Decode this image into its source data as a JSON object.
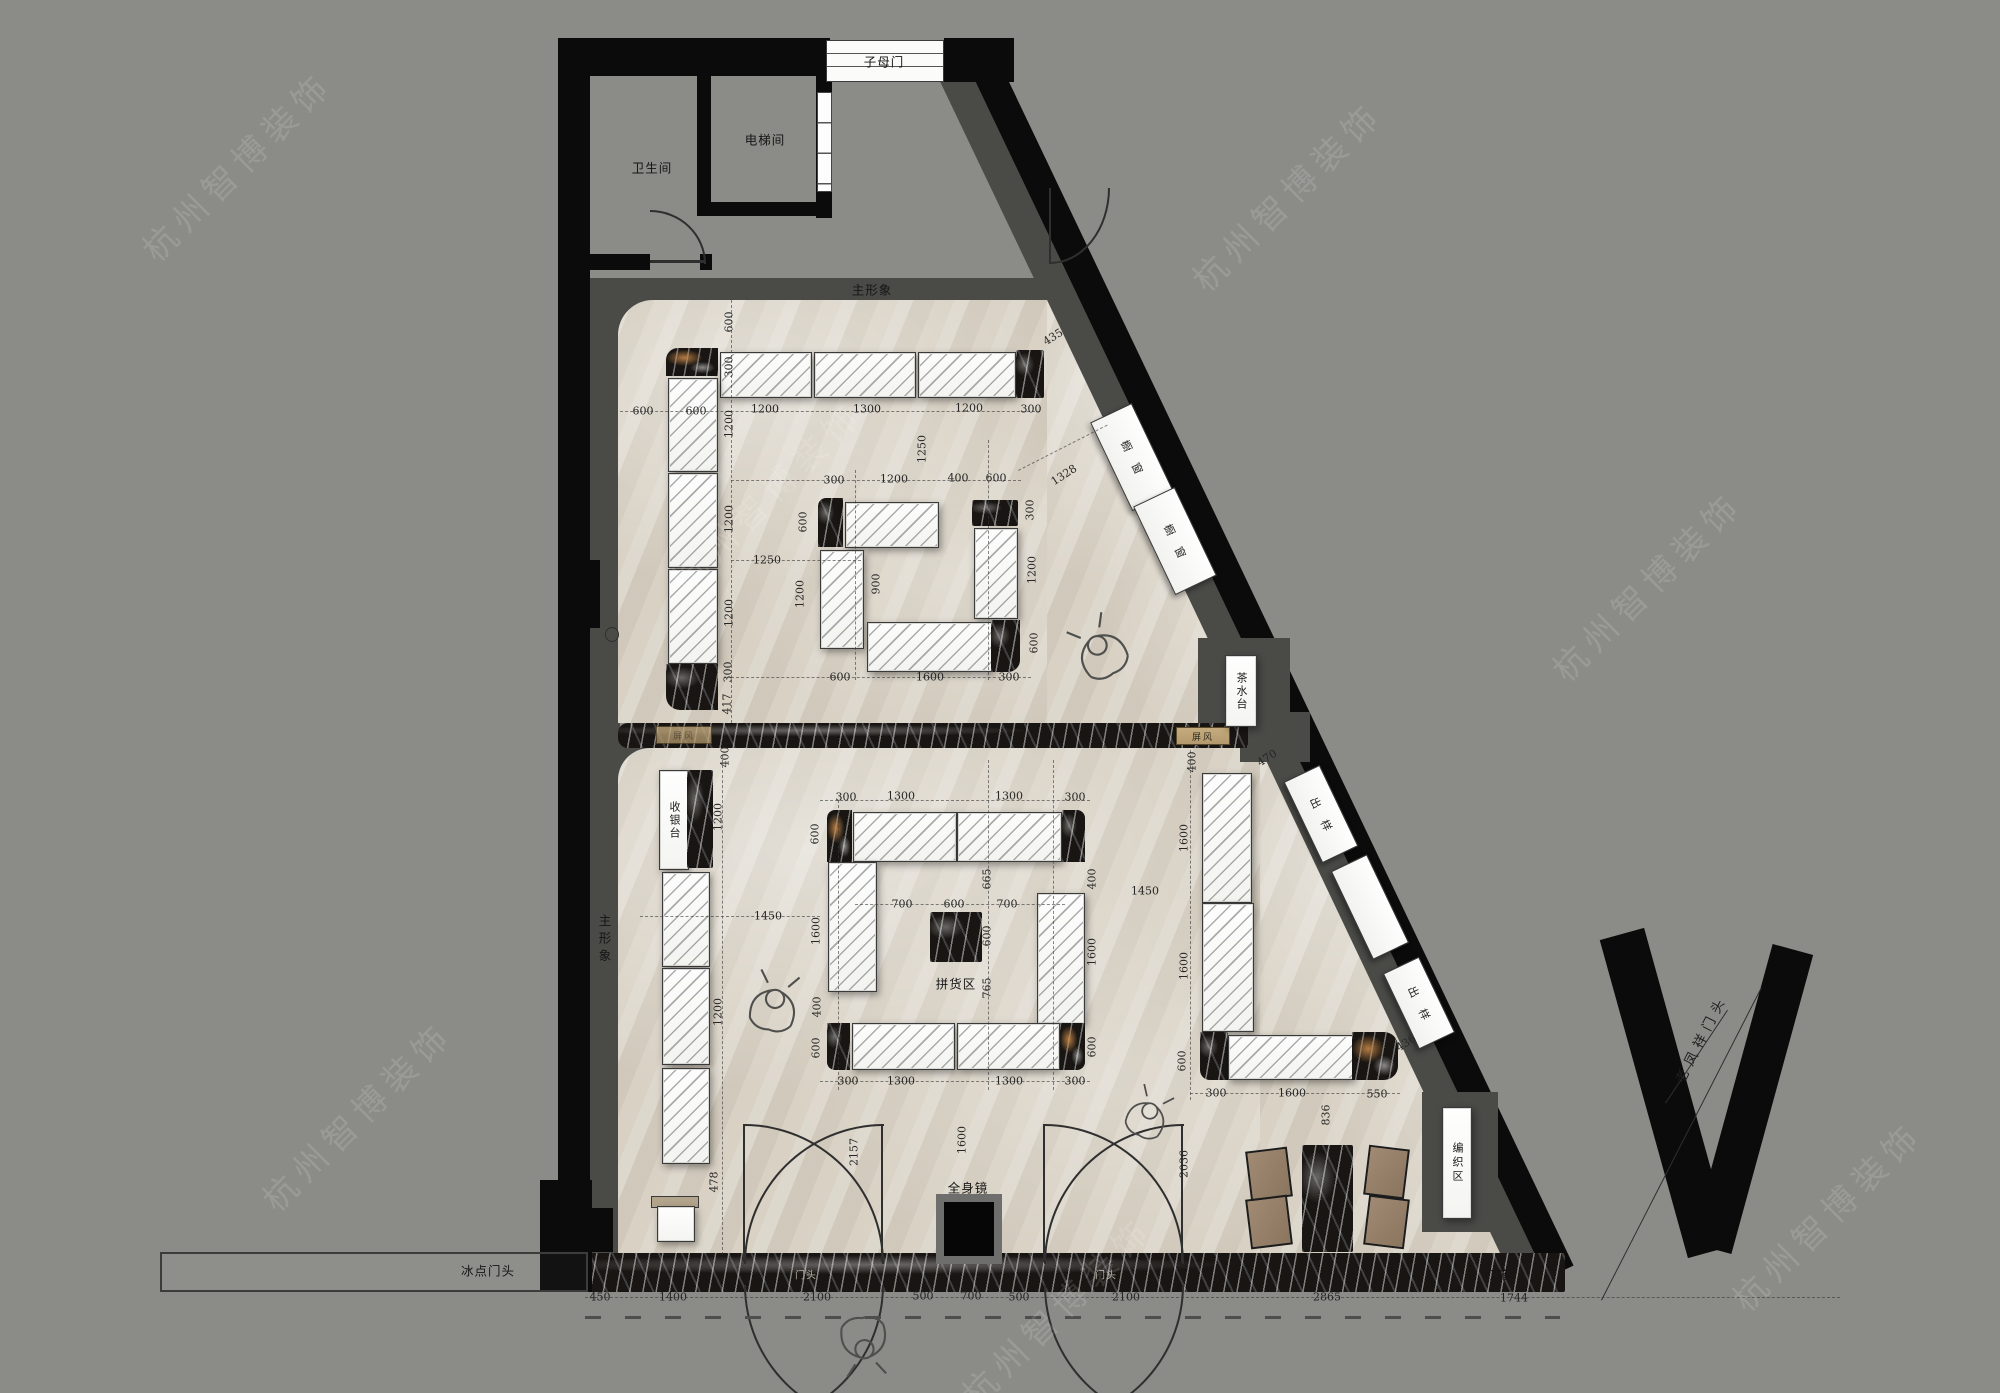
{
  "title": "老凤祥珠宝店 平面布置图",
  "watermark": "杭州智博装饰",
  "colors": {
    "bg": "#8b8c88",
    "wall": "#0b0b0b",
    "band": "#4a4a47",
    "floor": "#d7d0c3",
    "marble": "#181512",
    "tan": "#b49a6e",
    "chair": "#97816b",
    "wood": "#b3a48c"
  },
  "fixtures": {
    "cashier": "收银台",
    "tea": "茶水台",
    "weave": "编织区",
    "window": "橱窗",
    "sample": "出样",
    "screen": "屏风"
  },
  "annotations": {
    "labels": [
      {
        "t": "子母门",
        "x": 884,
        "y": 61,
        "r": 0,
        "c": "lbl"
      },
      {
        "t": "电梯间",
        "x": 765,
        "y": 139,
        "r": 0,
        "c": "lbl"
      },
      {
        "t": "卫生间",
        "x": 652,
        "y": 167,
        "r": 0,
        "c": "lbl"
      },
      {
        "t": "主形象",
        "x": 872,
        "y": 289,
        "r": 0,
        "c": "lbl"
      },
      {
        "t": "主形象",
        "x": 604,
        "y": 940,
        "r": 0,
        "c": "lbl v"
      },
      {
        "t": "拼货区",
        "x": 956,
        "y": 983,
        "r": 0,
        "c": "lbl"
      },
      {
        "t": "全身镜",
        "x": 968,
        "y": 1187,
        "r": 0,
        "c": "lbl"
      },
      {
        "t": "冰点门头",
        "x": 488,
        "y": 1270,
        "r": 0,
        "c": "lbl"
      },
      {
        "t": "灯箱",
        "x": 1497,
        "y": 1274,
        "r": 0,
        "c": "lbl"
      },
      {
        "t": "门头",
        "x": 806,
        "y": 1274,
        "r": 0,
        "c": "lbl light"
      },
      {
        "t": "门头",
        "x": 1106,
        "y": 1274,
        "r": 0,
        "c": "lbl light"
      },
      {
        "t": "老凤祥门头",
        "x": 1700,
        "y": 1038,
        "r": -63,
        "c": "lbl spaced"
      }
    ],
    "dims": [
      {
        "t": "600",
        "x": 729,
        "y": 322,
        "r": -90
      },
      {
        "t": "300",
        "x": 729,
        "y": 367,
        "r": -90
      },
      {
        "t": "600",
        "x": 643,
        "y": 411,
        "r": 0
      },
      {
        "t": "600",
        "x": 696,
        "y": 411,
        "r": 0
      },
      {
        "t": "1200",
        "x": 765,
        "y": 409,
        "r": 0
      },
      {
        "t": "1300",
        "x": 867,
        "y": 409,
        "r": 0
      },
      {
        "t": "1200",
        "x": 969,
        "y": 408,
        "r": 0
      },
      {
        "t": "300",
        "x": 1031,
        "y": 409,
        "r": 0
      },
      {
        "t": "435",
        "x": 1053,
        "y": 337,
        "r": -32
      },
      {
        "t": "1200",
        "x": 729,
        "y": 424,
        "r": -90
      },
      {
        "t": "1200",
        "x": 729,
        "y": 519,
        "r": -90
      },
      {
        "t": "1200",
        "x": 729,
        "y": 613,
        "r": -90
      },
      {
        "t": "300",
        "x": 728,
        "y": 672,
        "r": -90
      },
      {
        "t": "417",
        "x": 727,
        "y": 704,
        "r": -90
      },
      {
        "t": "300",
        "x": 834,
        "y": 480,
        "r": 0
      },
      {
        "t": "1200",
        "x": 894,
        "y": 479,
        "r": 0
      },
      {
        "t": "400",
        "x": 958,
        "y": 478,
        "r": 0
      },
      {
        "t": "600",
        "x": 996,
        "y": 478,
        "r": 0
      },
      {
        "t": "1328",
        "x": 1064,
        "y": 475,
        "r": -33
      },
      {
        "t": "600",
        "x": 803,
        "y": 522,
        "r": -90
      },
      {
        "t": "1200",
        "x": 800,
        "y": 594,
        "r": -90
      },
      {
        "t": "1250",
        "x": 922,
        "y": 449,
        "r": -90
      },
      {
        "t": "1250",
        "x": 767,
        "y": 560,
        "r": 0
      },
      {
        "t": "900",
        "x": 876,
        "y": 584,
        "r": -90
      },
      {
        "t": "300",
        "x": 1030,
        "y": 510,
        "r": -90
      },
      {
        "t": "1200",
        "x": 1032,
        "y": 570,
        "r": -90
      },
      {
        "t": "600",
        "x": 1034,
        "y": 643,
        "r": -90
      },
      {
        "t": "600",
        "x": 840,
        "y": 677,
        "r": 0
      },
      {
        "t": "1600",
        "x": 930,
        "y": 677,
        "r": 0
      },
      {
        "t": "300",
        "x": 1009,
        "y": 677,
        "r": 0
      },
      {
        "t": "1450",
        "x": 1145,
        "y": 891,
        "r": 0
      },
      {
        "t": "400",
        "x": 725,
        "y": 757,
        "r": -90
      },
      {
        "t": "1200",
        "x": 718,
        "y": 817,
        "r": -90
      },
      {
        "t": "1200",
        "x": 718,
        "y": 1012,
        "r": -90
      },
      {
        "t": "478",
        "x": 714,
        "y": 1182,
        "r": -90
      },
      {
        "t": "300",
        "x": 846,
        "y": 797,
        "r": 0
      },
      {
        "t": "1300",
        "x": 901,
        "y": 796,
        "r": 0
      },
      {
        "t": "1300",
        "x": 1009,
        "y": 796,
        "r": 0
      },
      {
        "t": "300",
        "x": 1075,
        "y": 797,
        "r": 0
      },
      {
        "t": "600",
        "x": 815,
        "y": 834,
        "r": -90
      },
      {
        "t": "1600",
        "x": 816,
        "y": 931,
        "r": -90
      },
      {
        "t": "400",
        "x": 817,
        "y": 1007,
        "r": -90
      },
      {
        "t": "600",
        "x": 816,
        "y": 1048,
        "r": -90
      },
      {
        "t": "700",
        "x": 902,
        "y": 904,
        "r": 0
      },
      {
        "t": "600",
        "x": 954,
        "y": 904,
        "r": 0
      },
      {
        "t": "700",
        "x": 1007,
        "y": 904,
        "r": 0
      },
      {
        "t": "665",
        "x": 987,
        "y": 879,
        "r": -90
      },
      {
        "t": "600",
        "x": 987,
        "y": 936,
        "r": -90
      },
      {
        "t": "765",
        "x": 987,
        "y": 988,
        "r": -90
      },
      {
        "t": "400",
        "x": 1092,
        "y": 879,
        "r": -90
      },
      {
        "t": "1600",
        "x": 1092,
        "y": 952,
        "r": -90
      },
      {
        "t": "600",
        "x": 1092,
        "y": 1047,
        "r": -90
      },
      {
        "t": "300",
        "x": 848,
        "y": 1081,
        "r": 0
      },
      {
        "t": "1300",
        "x": 901,
        "y": 1081,
        "r": 0
      },
      {
        "t": "1300",
        "x": 1009,
        "y": 1081,
        "r": 0
      },
      {
        "t": "300",
        "x": 1075,
        "y": 1081,
        "r": 0
      },
      {
        "t": "1450",
        "x": 768,
        "y": 916,
        "r": 0
      },
      {
        "t": "400",
        "x": 1192,
        "y": 762,
        "r": -90
      },
      {
        "t": "470",
        "x": 1267,
        "y": 758,
        "r": -33
      },
      {
        "t": "1600",
        "x": 1184,
        "y": 838,
        "r": -90
      },
      {
        "t": "1600",
        "x": 1184,
        "y": 966,
        "r": -90
      },
      {
        "t": "600",
        "x": 1182,
        "y": 1061,
        "r": -90
      },
      {
        "t": "300",
        "x": 1216,
        "y": 1093,
        "r": 0
      },
      {
        "t": "1600",
        "x": 1292,
        "y": 1093,
        "r": 0
      },
      {
        "t": "550",
        "x": 1377,
        "y": 1094,
        "r": 0
      },
      {
        "t": "436",
        "x": 1406,
        "y": 1043,
        "r": -33
      },
      {
        "t": "2157",
        "x": 854,
        "y": 1152,
        "r": -90
      },
      {
        "t": "1600",
        "x": 962,
        "y": 1140,
        "r": -90
      },
      {
        "t": "2036",
        "x": 1184,
        "y": 1164,
        "r": -90
      },
      {
        "t": "836",
        "x": 1326,
        "y": 1115,
        "r": -90
      },
      {
        "t": "450",
        "x": 600,
        "y": 1297,
        "r": 0
      },
      {
        "t": "1400",
        "x": 673,
        "y": 1297,
        "r": 0
      },
      {
        "t": "2100",
        "x": 817,
        "y": 1297,
        "r": 0
      },
      {
        "t": "500",
        "x": 923,
        "y": 1296,
        "r": 0
      },
      {
        "t": "700",
        "x": 971,
        "y": 1296,
        "r": 0
      },
      {
        "t": "500",
        "x": 1019,
        "y": 1297,
        "r": 0
      },
      {
        "t": "2100",
        "x": 1126,
        "y": 1297,
        "r": 0
      },
      {
        "t": "2865",
        "x": 1327,
        "y": 1297,
        "r": 0
      },
      {
        "t": "1744",
        "x": 1514,
        "y": 1298,
        "r": 0
      }
    ]
  },
  "watermark_positions": [
    {
      "x": 110,
      "y": 140
    },
    {
      "x": 640,
      "y": 470
    },
    {
      "x": 1160,
      "y": 170
    },
    {
      "x": 1520,
      "y": 560
    },
    {
      "x": 230,
      "y": 1090
    },
    {
      "x": 930,
      "y": 1285
    },
    {
      "x": 1700,
      "y": 1190
    }
  ]
}
